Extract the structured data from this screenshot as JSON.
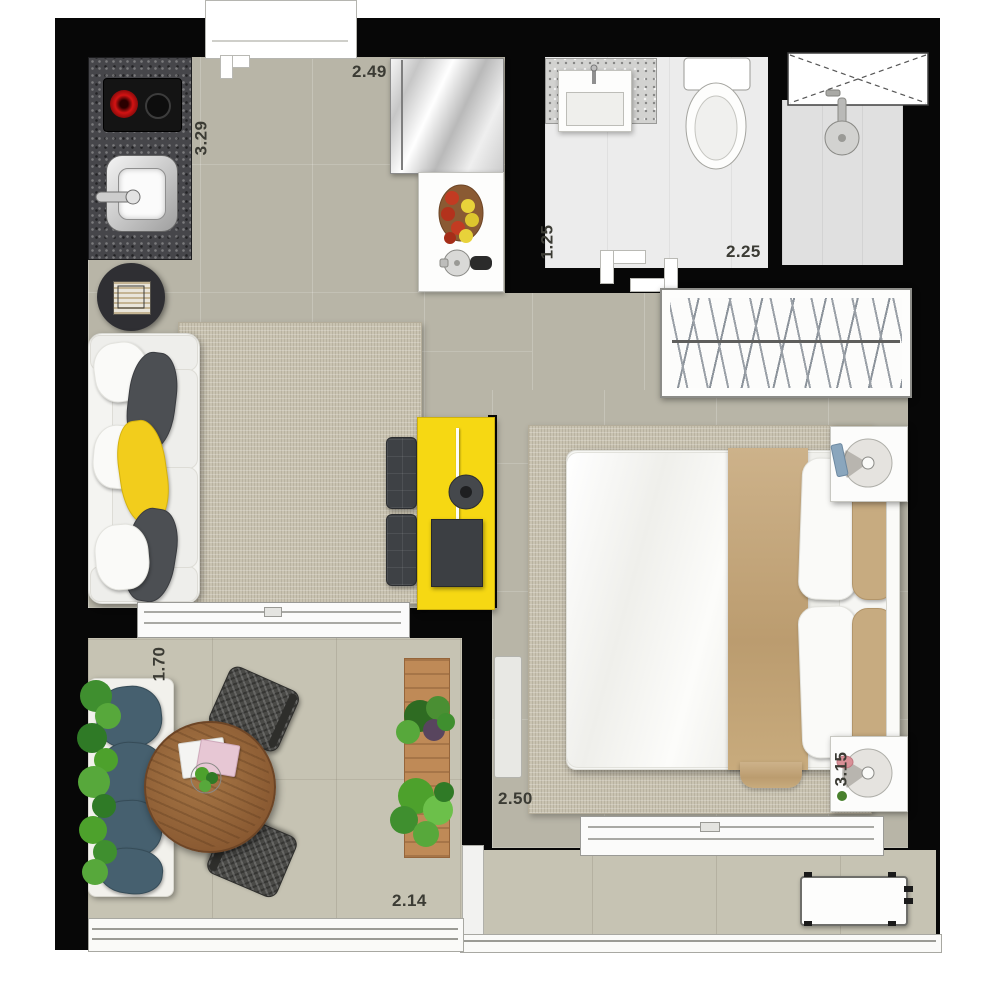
{
  "title": "studio-apartment-floor-plan",
  "dimensions": {
    "kitchen_length": "3.29",
    "kitchen_width": "2.49",
    "bath_depth": "1.25",
    "bath_width": "2.25",
    "balcony_depth": "1.70",
    "balcony_width": "2.14",
    "bedroom_width": "2.50",
    "bedroom_length": "3.15"
  },
  "palette": {
    "wall": "#070707",
    "floor": "#b8b5a7",
    "balcony_floor": "#c6c3b3",
    "bathroom_floor": "#ececec",
    "rug": "#c9c3b1",
    "accent_yellow": "#f6d813",
    "bed_throw": "#bb9c6f",
    "cushion_blue": "#46606f",
    "table_wood": "#8a5a32",
    "plant_green": "#4da12c"
  },
  "rooms": {
    "kitchen_living": "open kitchen and living room",
    "bathroom": "bathroom with shower",
    "bedroom": "bedroom",
    "balcony": "balcony terrace",
    "service_balcony": "service balcony with AC condenser",
    "wardrobe": "wardrobe closet"
  }
}
